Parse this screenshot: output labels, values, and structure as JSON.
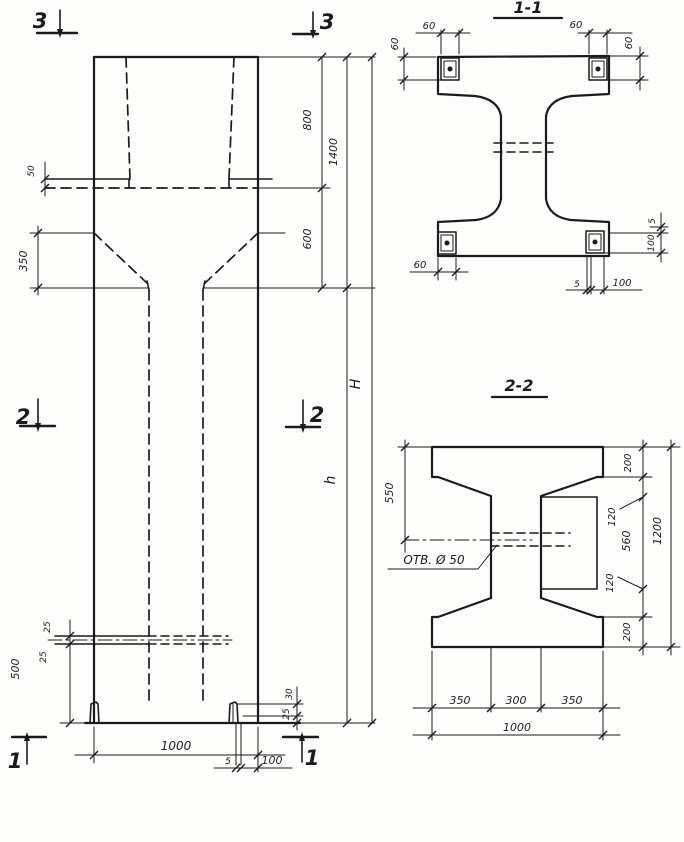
{
  "elevation": {
    "marks": {
      "sec3_left": "3",
      "sec3_right": "3",
      "sec2_left": "2",
      "sec2_right": "2",
      "sec1_left": "1",
      "sec1_right": "1"
    },
    "dims": {
      "ledge_gap": "50",
      "taper_side": "350",
      "top_cavity": "800",
      "taper": "600",
      "upper_total": "1400",
      "overall_height": "H",
      "shaft_height": "h",
      "hole_above": "25",
      "hole_below": "25",
      "hole_to_base": "500",
      "corner_top": "30",
      "corner_bot": "25",
      "plate_t": "5",
      "plate_leg": "100",
      "base_width": "1000"
    }
  },
  "section1": {
    "title": "1-1",
    "dims": {
      "tl_width": "60",
      "tl_height": "60",
      "tr_width": "60",
      "tr_height": "60",
      "bl_width": "60",
      "br_plate_t": "5",
      "br_plate_leg": "100",
      "side_gap": "5",
      "side_leg": "100"
    }
  },
  "section2": {
    "title": "2-2",
    "hole_label": "ОТВ. Ø 50",
    "dims": {
      "left_to_hole": "550",
      "top_flange": "200",
      "upper_inner": "120",
      "middle": "560",
      "lower_inner": "120",
      "bottom_flange": "200",
      "height": "1200",
      "bot_left": "350",
      "bot_mid": "300",
      "bot_right": "350",
      "bot_total": "1000"
    }
  }
}
